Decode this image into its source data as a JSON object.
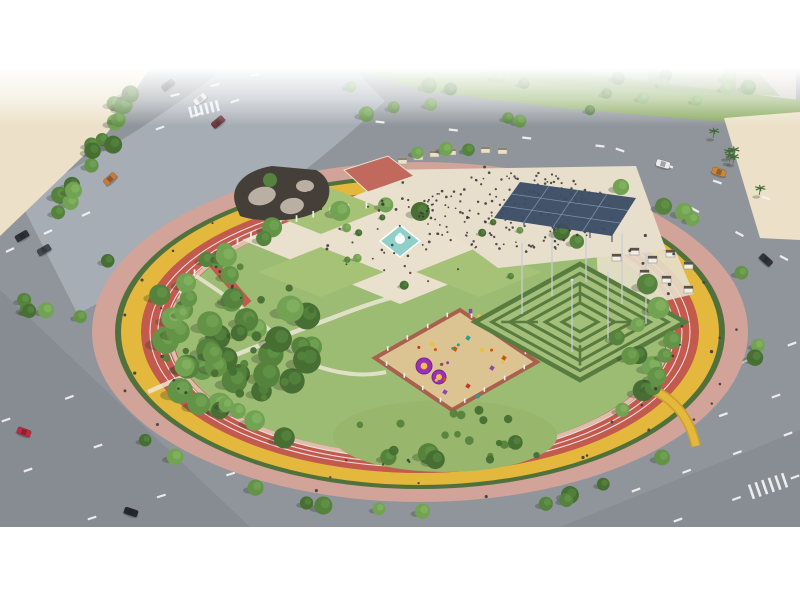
{
  "meta": {
    "description": "Aerial 3D architectural rendering of a circular city park with running track, cycle path, hedge maze, playground, fountain plaza and surrounding roads"
  },
  "canvas": {
    "width": 800,
    "height": 600,
    "band_top": 68,
    "band_bottom": 527
  },
  "inventory": [
    "circular-park",
    "pink-promenade-ring",
    "yellow-cycle-path",
    "red-running-track",
    "central-fountain-plaza",
    "lawn-quadrants",
    "event-plaza-with-crowd",
    "solar-canopy",
    "hedge-maze",
    "children-playground",
    "tree-grove",
    "shaded-garden-building",
    "red-terrace",
    "cabana-lounge-area",
    "surrounding-roads",
    "cars",
    "palm-median",
    "sand-lot",
    "distant-buildings",
    "cyclists",
    "runners",
    "pedestrians"
  ],
  "colors": {
    "letterbox": "#ffffff",
    "asphalt": "#8f959b",
    "asphalt_light": "#a6adb4",
    "lane_marking": "#f4f5f6",
    "shade_overlay": "#5d6268",
    "sand": "#ece1c8",
    "green_strip": "#8aab60",
    "green_strip_dark": "#789a55",
    "building_far": "#d7d0c1",
    "promenade": "#d2a399",
    "hedge": "#50703c",
    "cycle_path": "#e3b83c",
    "track": "#c25a4e",
    "park_green": "#9cbc73",
    "walkway": "#ece6d5",
    "plaza": "#e9e1cd",
    "lawn": "#a5c277",
    "fountain_pool": "#90d0c8",
    "fountain_water": "#ffffff",
    "event_plaza": "#e7dfcb",
    "canopy": "#3c4d66",
    "canopy_grid": "#7d90ac",
    "terrace_red": "#c0695c",
    "roof_dark": "#453f39",
    "rock_gray": "#b9b0a3",
    "maze_floor": "#a3bf79",
    "maze_hedge": "#587b40",
    "pole": "#c9cdd0",
    "cabana": "#f1eee6",
    "cabana_top": "#5a5248",
    "playground_sand": "#dcc392",
    "playground_border": "#a9604e",
    "fence": "#f4f2ec",
    "south_lawn": "#98b66c",
    "person": "#3c3c3c",
    "tree_shadow": "rgba(40,50,30,0.28)",
    "bridge_edge": "#c9a02e",
    "stall": "#e9e1cd",
    "stall_roof": "#8d8270"
  },
  "palettes": {
    "tree": [
      "#476f33",
      "#55833d",
      "#639347",
      "#72a353",
      "#83b261"
    ],
    "banner": [
      "#8e44ad",
      "#e7c33b",
      "#c0392b",
      "#3f8f4f",
      "#d87f2e"
    ],
    "equipment": [
      "#d35400",
      "#2a9d8f",
      "#e7c33b",
      "#8e44ad",
      "#c0392b"
    ]
  },
  "park": {
    "cx": 420,
    "cy": 332,
    "rings": [
      {
        "name": "promenade-ring",
        "rx": 328,
        "ry": 170,
        "fill": "promenade"
      },
      {
        "name": "hedge-ring",
        "rx": 305,
        "ry": 157,
        "fill": "hedge"
      },
      {
        "name": "cycle-path-ring",
        "rx": 299,
        "ry": 153,
        "fill": "cycle_path"
      },
      {
        "name": "running-track-ring",
        "rx": 279,
        "ry": 141,
        "fill": "track"
      },
      {
        "name": "inner-park-green",
        "rx": 247,
        "ry": 123,
        "fill": "park_green"
      }
    ],
    "lane_lines": [
      {
        "rx": 254,
        "ry": 127
      },
      {
        "rx": 262,
        "ry": 131
      },
      {
        "rx": 270,
        "ry": 135
      }
    ]
  },
  "maze": {
    "cx": 580,
    "cy": 322,
    "a": 105,
    "b": 58,
    "ring_scales": [
      1,
      0.84,
      0.67,
      0.5,
      0.33,
      0.17
    ],
    "poles": [
      [
        -58,
        -8
      ],
      [
        -28,
        -26
      ],
      [
        6,
        -40
      ],
      [
        42,
        -18
      ],
      [
        66,
        2
      ],
      [
        28,
        20
      ],
      [
        -8,
        30
      ]
    ]
  },
  "playground": {
    "points": [
      [
        460,
        310
      ],
      [
        537,
        362
      ],
      [
        452,
        410
      ],
      [
        375,
        358
      ]
    ],
    "mats": [
      {
        "x": 424,
        "y": 366,
        "r": 8
      },
      {
        "x": 439,
        "y": 377,
        "r": 7
      }
    ],
    "equipment": [
      {
        "x": 468,
        "y": 338,
        "c": 1
      },
      {
        "x": 482,
        "y": 350,
        "c": 2
      },
      {
        "x": 455,
        "y": 349,
        "c": 0
      },
      {
        "x": 492,
        "y": 368,
        "c": 3
      },
      {
        "x": 468,
        "y": 386,
        "c": 4
      },
      {
        "x": 432,
        "y": 344,
        "c": 2
      },
      {
        "x": 504,
        "y": 358,
        "c": 0
      },
      {
        "x": 478,
        "y": 396,
        "c": 1
      },
      {
        "x": 445,
        "y": 392,
        "c": 3
      }
    ]
  },
  "stalls": [
    [
      398,
      158
    ],
    [
      414,
      154
    ],
    [
      430,
      151
    ],
    [
      447,
      149
    ],
    [
      464,
      147
    ],
    [
      481,
      147
    ],
    [
      498,
      148
    ]
  ],
  "cabanas": [
    [
      612,
      254
    ],
    [
      630,
      248
    ],
    [
      648,
      256
    ],
    [
      666,
      250
    ],
    [
      684,
      262
    ],
    [
      640,
      270
    ],
    [
      662,
      276
    ],
    [
      684,
      286
    ]
  ],
  "colonnade": {
    "cx": 420,
    "cy": 332,
    "rx": 252,
    "ry": 127,
    "deg_start": 198,
    "deg_end": 262,
    "count": 16
  },
  "clusters": [
    {
      "name": "left-grove-trees",
      "kind": "tree",
      "shape": "ellipse",
      "cx": 237,
      "cy": 332,
      "rx": 92,
      "ry": 80,
      "count": 36,
      "rmin": 8,
      "rmax": 14,
      "seed": 11
    },
    {
      "name": "grove-understory",
      "kind": "bush",
      "shape": "ellipse",
      "cx": 242,
      "cy": 336,
      "rx": 88,
      "ry": 72,
      "count": 18,
      "rmin": 3,
      "rmax": 5,
      "seed": 121
    },
    {
      "name": "inner-ring-trees",
      "kind": "tree",
      "shape": "ring",
      "cx": 420,
      "cy": 332,
      "rx": 250,
      "ry": 124,
      "jitter": 9,
      "count": 30,
      "rmin": 7,
      "rmax": 11,
      "seed": 22
    },
    {
      "name": "promenade-trees",
      "kind": "tree",
      "shape": "ring",
      "cx": 420,
      "cy": 332,
      "rx": 344,
      "ry": 181,
      "jitter": 7,
      "count": 24,
      "rmin": 6,
      "rmax": 10,
      "seed": 33
    },
    {
      "name": "top-strip-trees",
      "kind": "tree",
      "shape": "rect",
      "x": 310,
      "y": 72,
      "w": 470,
      "h": 50,
      "count": 20,
      "rmin": 5,
      "rmax": 8,
      "seed": 44
    },
    {
      "name": "sand-edge-trees",
      "kind": "tree",
      "shape": "line",
      "x1": 52,
      "y1": 224,
      "x2": 146,
      "y2": 74,
      "jitter": 9,
      "count": 16,
      "rmin": 6,
      "rmax": 9,
      "seed": 55
    },
    {
      "name": "lawn-accent-trees",
      "kind": "tree",
      "shape": "rect",
      "x": 330,
      "y": 192,
      "w": 200,
      "h": 96,
      "count": 10,
      "rmin": 3,
      "rmax": 5,
      "seed": 66
    },
    {
      "name": "south-lawn-bushes",
      "kind": "bush",
      "shape": "rect",
      "x": 350,
      "y": 410,
      "w": 190,
      "h": 52,
      "count": 16,
      "rmin": 3,
      "rmax": 5,
      "seed": 77
    },
    {
      "name": "maze-side-trees",
      "kind": "tree",
      "shape": "rect",
      "x": 614,
      "y": 304,
      "w": 88,
      "h": 80,
      "count": 5,
      "rmin": 7,
      "rmax": 10,
      "seed": 88
    },
    {
      "name": "right-median-palms",
      "kind": "palm",
      "shape": "line",
      "x1": 714,
      "y1": 132,
      "x2": 776,
      "y2": 222,
      "jitter": 6,
      "count": 6,
      "seed": 99
    },
    {
      "name": "left-edge-trees",
      "kind": "tree",
      "shape": "line",
      "x1": 12,
      "y1": 302,
      "x2": 72,
      "y2": 318,
      "jitter": 5,
      "count": 4,
      "rmin": 6,
      "rmax": 8,
      "seed": 111
    },
    {
      "name": "event-crowd",
      "kind": "person",
      "shape": "ellipse",
      "cx": 516,
      "cy": 212,
      "rx": 106,
      "ry": 40,
      "count": 200,
      "size": 1.1,
      "seed": 131
    },
    {
      "name": "plaza-walkers",
      "kind": "person",
      "shape": "ellipse",
      "cx": 400,
      "cy": 242,
      "rx": 88,
      "ry": 44,
      "count": 34,
      "size": 1.2,
      "seed": 141
    },
    {
      "name": "runners",
      "kind": "person",
      "shape": "ring",
      "cx": 420,
      "cy": 332,
      "rx": 262,
      "ry": 131,
      "jitter": 5,
      "count": 24,
      "size": 1.4,
      "seed": 151
    },
    {
      "name": "cyclists",
      "kind": "person",
      "shape": "ring",
      "cx": 420,
      "cy": 332,
      "rx": 297,
      "ry": 151,
      "jitter": 3,
      "count": 18,
      "size": 1.4,
      "seed": 161
    },
    {
      "name": "promenade-walkers",
      "kind": "person",
      "shape": "ring",
      "cx": 420,
      "cy": 332,
      "rx": 318,
      "ry": 166,
      "jitter": 5,
      "count": 12,
      "size": 1.3,
      "seed": 171
    },
    {
      "name": "playground-kids",
      "kind": "kid",
      "shape": "ellipse",
      "cx": 458,
      "cy": 360,
      "rx": 46,
      "ry": 25,
      "count": 12,
      "size": 1.5,
      "seed": 181
    },
    {
      "name": "entry-walkers",
      "kind": "person",
      "shape": "line",
      "x1": 208,
      "y1": 258,
      "x2": 244,
      "y2": 300,
      "jitter": 3,
      "count": 5,
      "size": 1.3,
      "seed": 191
    }
  ],
  "cars": [
    {
      "x": 168,
      "y": 85,
      "angle": -38,
      "color": "#3a3f45"
    },
    {
      "x": 200,
      "y": 99,
      "angle": -38,
      "color": "#e8e8e8"
    },
    {
      "x": 218,
      "y": 122,
      "angle": -40,
      "color": "#70343a"
    },
    {
      "x": 110,
      "y": 179,
      "angle": -42,
      "color": "#c77a3a"
    },
    {
      "x": 22,
      "y": 236,
      "angle": -30,
      "color": "#2e3236"
    },
    {
      "x": 44,
      "y": 250,
      "angle": -30,
      "color": "#43484e"
    },
    {
      "x": 24,
      "y": 432,
      "angle": 20,
      "color": "#c2273a"
    },
    {
      "x": 131,
      "y": 512,
      "angle": 18,
      "color": "#26292c"
    },
    {
      "x": 663,
      "y": 164,
      "angle": 16,
      "color": "#ececec"
    },
    {
      "x": 719,
      "y": 172,
      "angle": 18,
      "color": "#d1862f"
    },
    {
      "x": 766,
      "y": 260,
      "angle": 42,
      "color": "#303438"
    }
  ],
  "dash_lines": [
    {
      "x1": 175,
      "y1": 95,
      "x2": 255,
      "y2": 75,
      "n": 3
    },
    {
      "x1": 160,
      "y1": 128,
      "x2": 235,
      "y2": 101,
      "n": 3
    },
    {
      "x1": 380,
      "y1": 122,
      "x2": 600,
      "y2": 146,
      "n": 4
    },
    {
      "x1": 620,
      "y1": 150,
      "x2": 766,
      "y2": 198,
      "n": 4
    },
    {
      "x1": 695,
      "y1": 210,
      "x2": 784,
      "y2": 258,
      "n": 3
    },
    {
      "x1": 10,
      "y1": 250,
      "x2": 86,
      "y2": 214,
      "n": 3
    },
    {
      "x1": 6,
      "y1": 420,
      "x2": 196,
      "y2": 352,
      "n": 4
    },
    {
      "x1": 28,
      "y1": 470,
      "x2": 238,
      "y2": 398,
      "n": 4
    },
    {
      "x1": 92,
      "y1": 518,
      "x2": 300,
      "y2": 452,
      "n": 4
    },
    {
      "x1": 636,
      "y1": 490,
      "x2": 788,
      "y2": 434,
      "n": 4
    },
    {
      "x1": 678,
      "y1": 520,
      "x2": 795,
      "y2": 477,
      "n": 3
    },
    {
      "x1": 618,
      "y1": 452,
      "x2": 776,
      "y2": 396,
      "n": 4
    },
    {
      "x1": 700,
      "y1": 378,
      "x2": 792,
      "y2": 344,
      "n": 3
    }
  ],
  "crosswalks": [
    {
      "cx": 204,
      "cy": 109,
      "angle": -14,
      "n": 6,
      "len": 11,
      "gap": 5.5
    },
    {
      "cx": 768,
      "cy": 486,
      "angle": -19,
      "n": 6,
      "len": 15,
      "gap": 7
    }
  ]
}
